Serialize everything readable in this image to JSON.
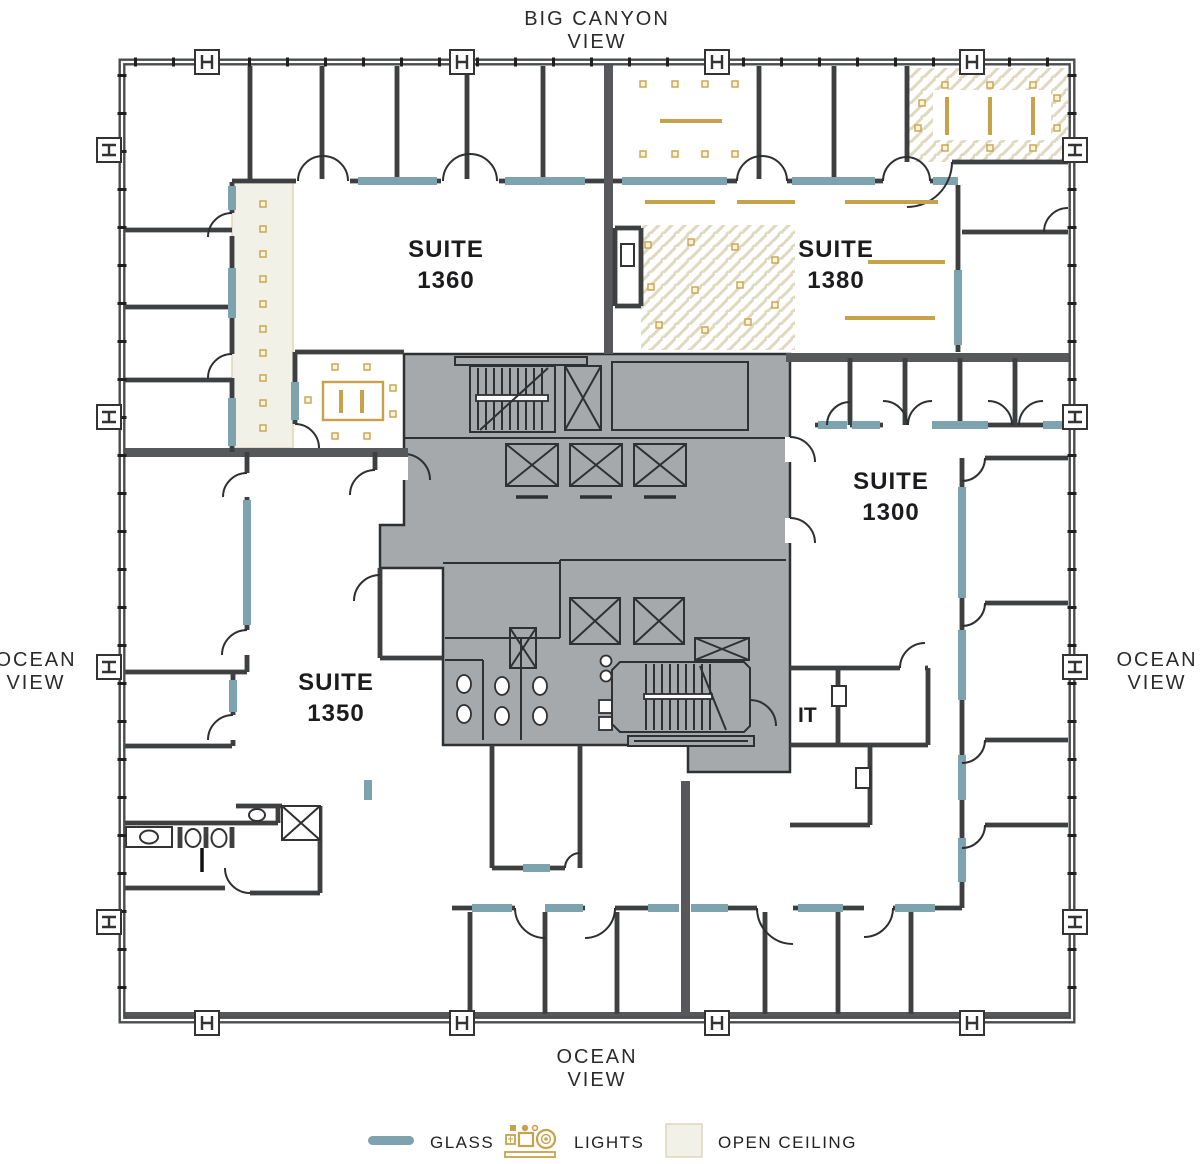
{
  "views": {
    "top": {
      "line1": "BIG CANYON",
      "line2": "VIEW"
    },
    "left": {
      "line1": "OCEAN",
      "line2": "VIEW"
    },
    "right": {
      "line1": "OCEAN",
      "line2": "VIEW"
    },
    "bottom": {
      "line1": "OCEAN",
      "line2": "VIEW"
    }
  },
  "suites": {
    "s1360": {
      "name": "SUITE",
      "number": "1360"
    },
    "s1380": {
      "name": "SUITE",
      "number": "1380"
    },
    "s1350": {
      "name": "SUITE",
      "number": "1350"
    },
    "s1300": {
      "name": "SUITE",
      "number": "1300"
    }
  },
  "rooms": {
    "it_label": "IT"
  },
  "legend": {
    "glass_label": "GLASS",
    "lights_label": "LIGHTS",
    "open_ceiling_label": "OPEN CEILING"
  },
  "colors": {
    "glass": "#7da4ae",
    "gold": "#c7a24b",
    "gold_dot_fill": "#faf3dd",
    "open_ceiling_fill": "#f2f1e8",
    "open_ceiling_border": "#ded6bd",
    "hatch_line": "#e0d9c2",
    "core_fill": "#a6a9ab",
    "core_line": "#2f3032",
    "wall_thick": "#57585b",
    "wall_line": "#3e3f41",
    "exterior_line": "#4b4c4e",
    "door_line": "#2e2f31",
    "text_dark": "#1c1c1e",
    "text_view": "#2b2b2b"
  }
}
